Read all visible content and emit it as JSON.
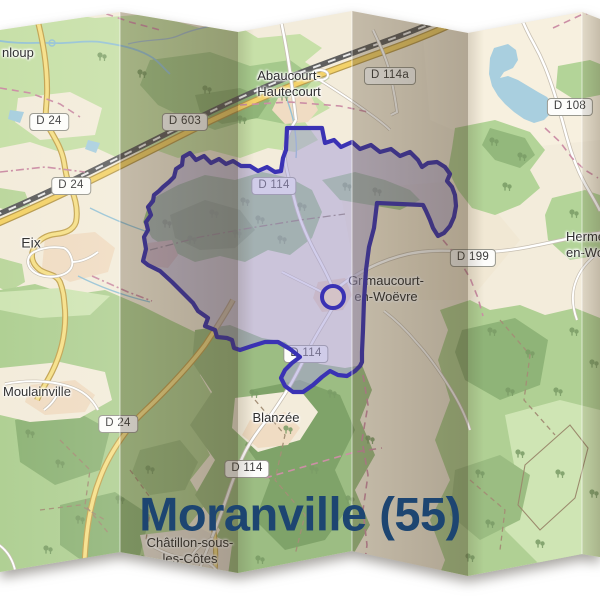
{
  "title": {
    "text": "Moranville (55)"
  },
  "map": {
    "towns": {
      "partial_nw": "nloup",
      "abaucourt": "Abaucourt-\nHautecourt",
      "eix": "Eix",
      "grimaucourt": "Grimaucourt-\nen-Woëvre",
      "hermeville": "Herméville-\nen-Woëvre",
      "moulainville": "Moulainville",
      "blanzee": "Blanzée",
      "chatillon": "Châtillon-sous-\nles-Côtes"
    },
    "road_shields": {
      "d24_nw": "D 24",
      "d24_w": "D 24",
      "d603": "D 603",
      "d114_center": "D 114",
      "d114a": "D 114a",
      "d108": "D 108",
      "d199": "D 199",
      "d114_south": "D 114",
      "d24_south": "D 24",
      "d114_blanzee": "D 114"
    },
    "colors": {
      "commune_outline": "#3a32b4",
      "commune_fill": "rgba(166,160,216,0.52)",
      "title_text": "#1d4571",
      "water": "#a9cfdf",
      "forest_light": "#cfe5b4",
      "forest_mid": "#b0d094",
      "forest_dark": "#8fb478",
      "road_primary": "#f3d269",
      "land": "#f3ecdb"
    }
  }
}
